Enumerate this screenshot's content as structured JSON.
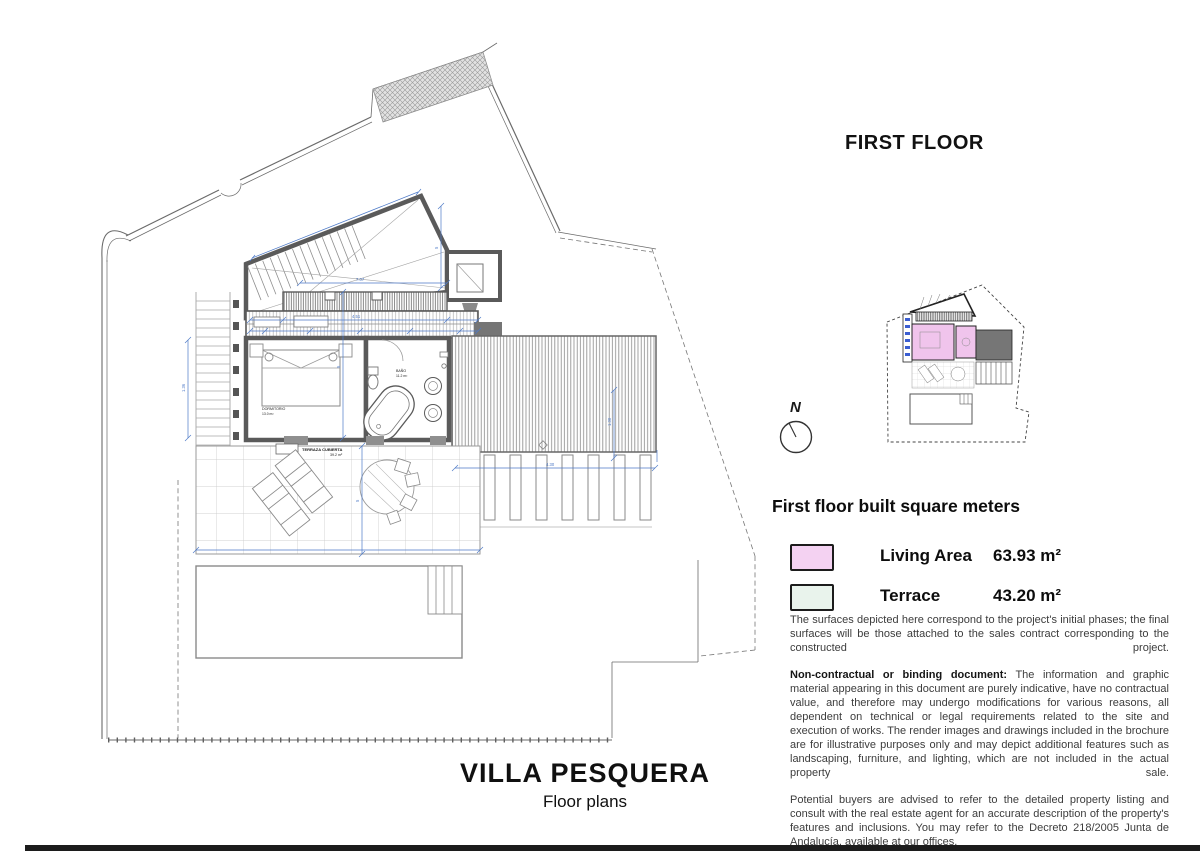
{
  "header": {
    "floor_title": "FIRST FLOOR"
  },
  "compass": {
    "label": "N"
  },
  "plan": {
    "labels": {
      "bedroom": "DORMITORIO",
      "bedroom_area": "13.0 m²",
      "bath": "BAÑO",
      "bath_area": "11.2 m²",
      "terrace": "TERRAZA CUBIERTA",
      "terrace_area": "39.2 m²"
    },
    "dims": [
      "7.07",
      "5",
      "4.51",
      "5",
      "5",
      "4.30",
      "1.30",
      "1.36"
    ]
  },
  "legend": {
    "title": "First floor built square meters",
    "items": [
      {
        "label": "Living Area",
        "value": "63.93 m²",
        "color": "#f4d2f2"
      },
      {
        "label": "Terrace",
        "value": "43.20 m²",
        "color": "#e9f3ec"
      }
    ]
  },
  "disclaimer": {
    "p1": "The surfaces depicted here correspond to the project's initial phases; the final surfaces will be those attached to the sales contract corresponding to the constructed project.",
    "p2_bold": "Non-contractual or binding document:",
    "p2_rest": " The information and graphic material appearing in this document are purely indicative, have no contractual value, and therefore may undergo modifications for various reasons, all dependent on technical or legal requirements related to the site and execution of works. The render images and drawings included in the brochure are for illustrative purposes only and may depict additional features such as landscaping, furniture, and lighting, which are not included in the actual property sale.",
    "p3": "Potential buyers are advised to refer to the detailed property listing and consult with the real estate agent for an accurate description of the property's features and inclusions. You may refer to the Decreto 218/2005 Junta de Andalucía, available at our offices."
  },
  "footer": {
    "title": "VILLA PESQUERA",
    "subtitle": "Floor plans"
  },
  "colors": {
    "wall": "#5a5a5a",
    "dim_blue": "#4d79c7",
    "dark_block": "#757575",
    "living_pink": "#f4d2f2",
    "terrace_mint": "#e9f3ec",
    "bottom_bar": "#1c1c1c"
  }
}
